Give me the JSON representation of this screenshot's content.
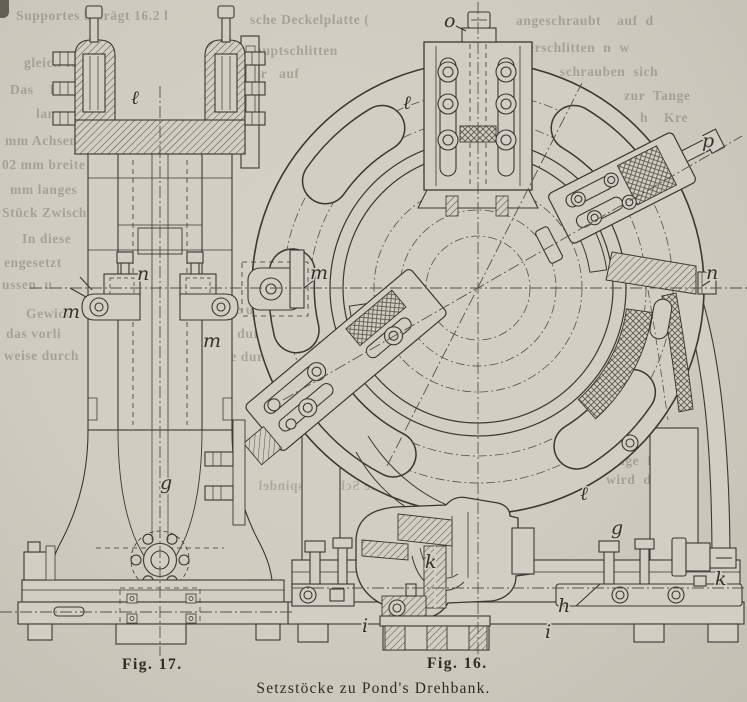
{
  "captions": {
    "fig17": "Fig. 17.",
    "fig16": "Fig. 16.",
    "main": "Setzstöcke zu Pond's Drehbank."
  },
  "figure17": {
    "name": "steady-rest-side-elevation",
    "labels": [
      {
        "t": "ℓ",
        "x": 131,
        "y": 104
      },
      {
        "t": "n",
        "x": 137,
        "y": 280
      },
      {
        "t": "m",
        "x": 62,
        "y": 318
      },
      {
        "t": "m",
        "x": 203,
        "y": 347
      },
      {
        "t": "g",
        "x": 160,
        "y": 489
      }
    ]
  },
  "figure16": {
    "name": "steady-rest-front-elevation",
    "labels": [
      {
        "t": "o",
        "x": 444,
        "y": 27
      },
      {
        "t": "ℓ",
        "x": 403,
        "y": 109
      },
      {
        "t": "p",
        "x": 702,
        "y": 147
      },
      {
        "t": "n",
        "x": 706,
        "y": 279
      },
      {
        "t": "m",
        "x": 310,
        "y": 279
      },
      {
        "t": "ℓ",
        "x": 580,
        "y": 500
      },
      {
        "t": "g",
        "x": 611,
        "y": 534
      },
      {
        "t": "k",
        "x": 425,
        "y": 568
      },
      {
        "t": "k",
        "x": 715,
        "y": 585
      },
      {
        "t": "h",
        "x": 558,
        "y": 612
      },
      {
        "t": "i",
        "x": 362,
        "y": 632
      },
      {
        "t": "i",
        "x": 545,
        "y": 638
      }
    ]
  },
  "ghost_text": [
    {
      "t": "Supportes beträgt 16.2 l",
      "x": 16,
      "y": 8
    },
    {
      "t": "gleich Re",
      "x": 24,
      "y": 55
    },
    {
      "t": "Das    Reitsto",
      "x": 10,
      "y": 82
    },
    {
      "t": "langen,",
      "x": 36,
      "y": 106
    },
    {
      "t": "mm Achsenhö",
      "x": 5,
      "y": 133
    },
    {
      "t": "02 mm breite",
      "x": 2,
      "y": 157
    },
    {
      "t": "mm langes",
      "x": 10,
      "y": 182
    },
    {
      "t": "Stück Zwisch",
      "x": 2,
      "y": 205
    },
    {
      "t": "In diese",
      "x": 22,
      "y": 231
    },
    {
      "t": "engesetzt",
      "x": 4,
      "y": 255
    },
    {
      "t": "ussen  u",
      "x": 2,
      "y": 277
    },
    {
      "t": "Gewich",
      "x": 26,
      "y": 306
    },
    {
      "t": "das vorli",
      "x": 6,
      "y": 326
    },
    {
      "t": "weise durch",
      "x": 4,
      "y": 348
    },
    {
      "t": "werden.",
      "x": 134,
      "y": 376
    },
    {
      "t": "ge u",
      "x": 228,
      "y": 302
    },
    {
      "t": "lle durch das",
      "x": 218,
      "y": 326
    },
    {
      "t": "ise durch we",
      "x": 220,
      "y": 349
    },
    {
      "t": "sche Deckelplatte (",
      "x": 250,
      "y": 12
    },
    {
      "t": "Hauptschlitten",
      "x": 244,
      "y": 43
    },
    {
      "t": "der   auf",
      "x": 246,
      "y": 66
    },
    {
      "t": "angeschraubt    auf  d",
      "x": 516,
      "y": 13
    },
    {
      "t": "erschlitten  n  w",
      "x": 528,
      "y": 40
    },
    {
      "t": "schrauben  sich",
      "x": 560,
      "y": 64
    },
    {
      "t": "zur  Tange",
      "x": 624,
      "y": 88
    },
    {
      "t": "h    Kre",
      "x": 640,
      "y": 110
    },
    {
      "t": "Beitr   Anlage  find",
      "x": 552,
      "y": 453
    },
    {
      "t": "Um         wird  d",
      "x": 548,
      "y": 472
    },
    {
      "t": "die Schlittenspindel",
      "x": 258,
      "y": 478,
      "m": true
    },
    {
      "t": "zelspindel  y",
      "x": 300,
      "y": 426,
      "m": true
    }
  ],
  "colors": {
    "paper": "#d2cec3",
    "ink": "#3a3833",
    "centerline": "#55524a",
    "ghost": "#6f695c"
  }
}
